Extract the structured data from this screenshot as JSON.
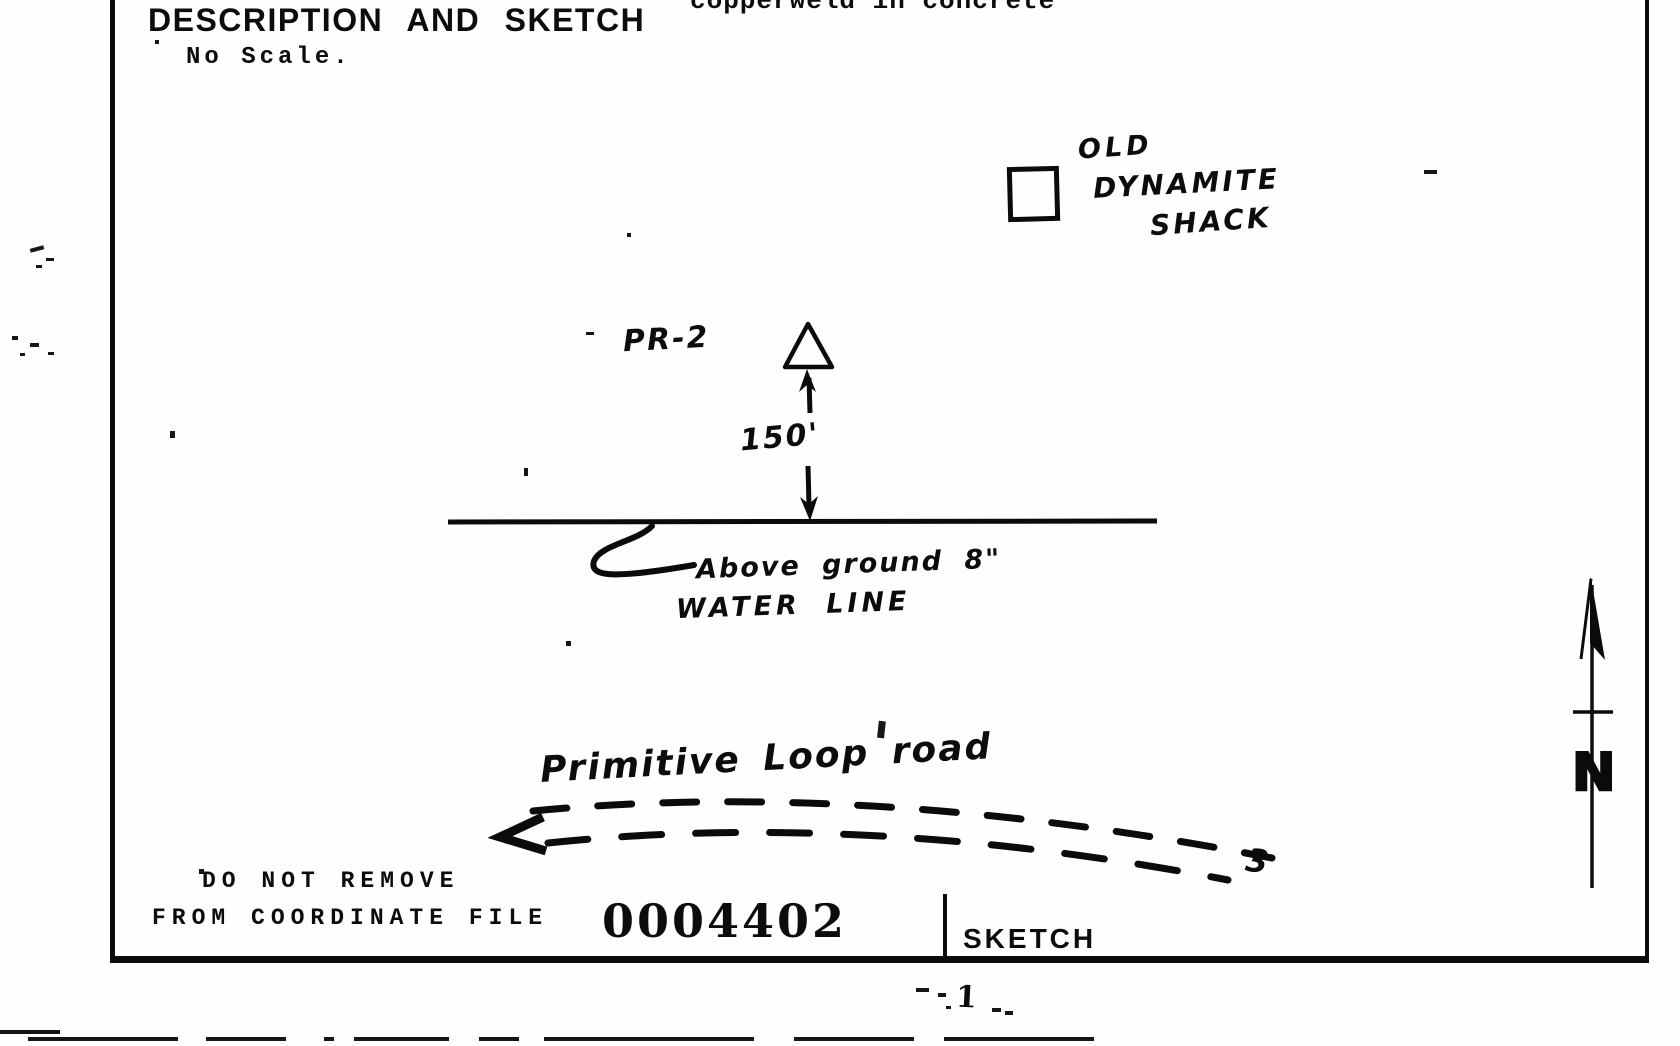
{
  "colors": {
    "ink": "#0b0b0b",
    "paper": "#fffefd"
  },
  "document": {
    "header": {
      "top_note_cutoff": "copperweld in concrete",
      "title": "DESCRIPTION AND SKETCH",
      "scale_note": "No Scale."
    },
    "sketch": {
      "shack_label_line1": "OLD",
      "shack_label_line2": "DYNAMITE",
      "shack_label_line3": "SHACK",
      "station_label": "PR-2",
      "distance_label": "150'",
      "water_line_label_line1": "Above ground 8\"",
      "water_line_label_line2": "WATER LINE",
      "road_label": "Primitive Loop road",
      "road_end_label": "3",
      "north_label": "N"
    },
    "footer": {
      "stamp_line1": "DO NOT REMOVE",
      "stamp_line2": "FROM COORDINATE FILE",
      "file_number": "0004402",
      "section_label": "SKETCH"
    },
    "page": {
      "page_number": "1"
    }
  }
}
